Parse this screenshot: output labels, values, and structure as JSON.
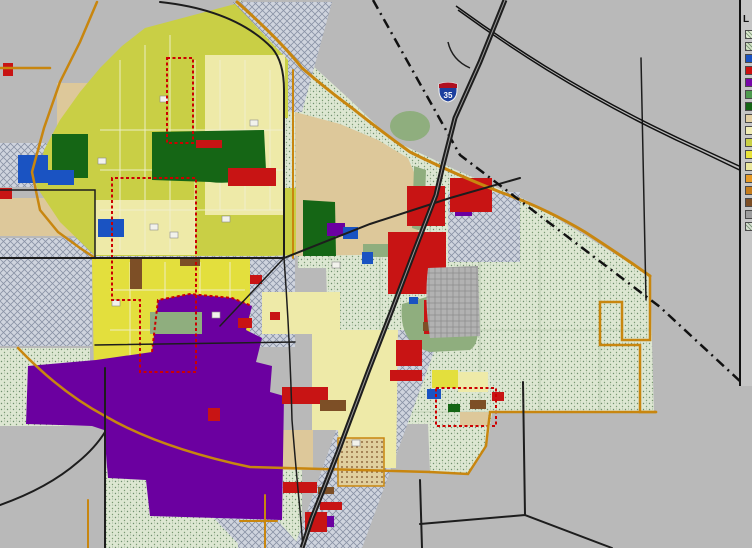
{
  "palette": {
    "bg_outside": "#b9b9b9",
    "legend_bg": "#c6c6c6",
    "zone_tan": "#ddc89a",
    "zone_yellowgreen": "#c9cf45",
    "zone_yellow_bright": "#e3df3d",
    "zone_paleyellow": "#eeeaa8",
    "zone_red": "#c81414",
    "zone_purple": "#6b00a0",
    "zone_darkgreen": "#156615",
    "zone_sage": "#8fae7e",
    "zone_blue": "#1a53c2",
    "zone_brown": "#7d4f26",
    "road_gold": "#c8860f",
    "road_black": "#1d1d1d",
    "rail_black": "#111111",
    "boundary_red": "#cc0000",
    "shield_red": "#b01020",
    "shield_blue": "#1c3f9e"
  },
  "shield": {
    "route": "35"
  },
  "legend": {
    "title": "L",
    "swatches": [
      {
        "color": "#dce8cf",
        "hatch": true
      },
      {
        "color": "#d0dfc2",
        "hatch": true
      },
      {
        "color": "#1a53c2",
        "hatch": false
      },
      {
        "color": "#cc1111",
        "hatch": false
      },
      {
        "color": "#7708a8",
        "hatch": false
      },
      {
        "color": "#4f9b4f",
        "hatch": false
      },
      {
        "color": "#166616",
        "hatch": false
      },
      {
        "color": "#e2cfa2",
        "hatch": false
      },
      {
        "color": "#f0ecb4",
        "hatch": false
      },
      {
        "color": "#c9cf45",
        "hatch": false
      },
      {
        "color": "#e8e239",
        "hatch": false
      },
      {
        "color": "#eae79b",
        "hatch": false
      },
      {
        "color": "#e79b28",
        "hatch": false
      },
      {
        "color": "#c67d1e",
        "hatch": false
      },
      {
        "color": "#7d4f26",
        "hatch": false
      },
      {
        "color": "#9e9e9e",
        "hatch": false
      },
      {
        "color": "#d5ddcf",
        "hatch": true
      }
    ]
  }
}
